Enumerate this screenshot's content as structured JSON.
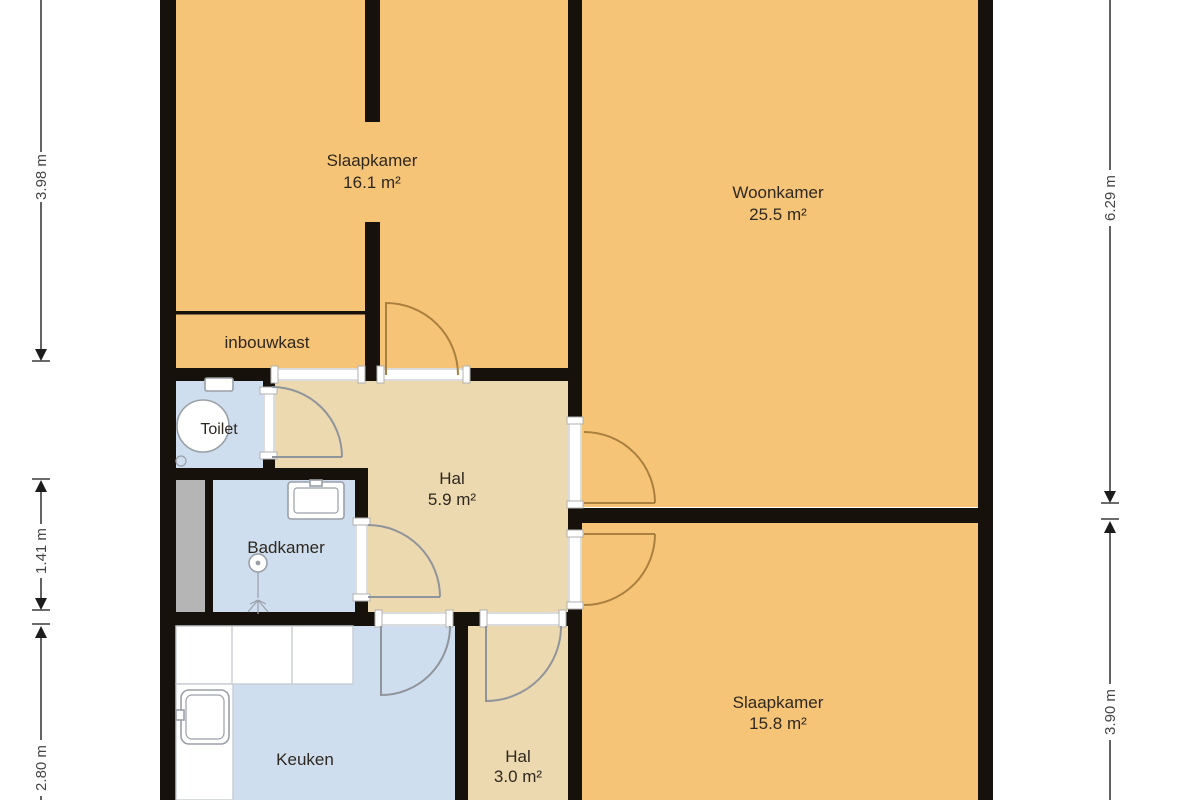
{
  "plan": {
    "rooms": [
      {
        "id": "slaapkamer-1",
        "name": "Slaapkamer",
        "area": "16.1 m²"
      },
      {
        "id": "woonkamer",
        "name": "Woonkamer",
        "area": "25.5 m²"
      },
      {
        "id": "inbouwkast",
        "name": "inbouwkast",
        "area": ""
      },
      {
        "id": "toilet",
        "name": "Toilet",
        "area": ""
      },
      {
        "id": "hal-1",
        "name": "Hal",
        "area": "5.9 m²"
      },
      {
        "id": "badkamer",
        "name": "Badkamer",
        "area": ""
      },
      {
        "id": "keuken",
        "name": "Keuken",
        "area": ""
      },
      {
        "id": "hal-2",
        "name": "Hal",
        "area": "3.0 m²"
      },
      {
        "id": "slaapkamer-2",
        "name": "Slaapkamer",
        "area": "15.8 m²"
      }
    ],
    "dimensions": {
      "left": [
        {
          "label": "3.98 m"
        },
        {
          "label": "1.41 m"
        },
        {
          "label": "2.80 m"
        }
      ],
      "right": [
        {
          "label": "6.29 m"
        },
        {
          "label": "3.90 m"
        }
      ]
    },
    "colors": {
      "room_fill_orange": "#f6c476",
      "hall_fill_tan": "#ecd9b0",
      "wet_room_fill_blue": "#cfdeee",
      "shaft_fill_gray": "#b5b5b5",
      "wall": "#17110b"
    }
  }
}
